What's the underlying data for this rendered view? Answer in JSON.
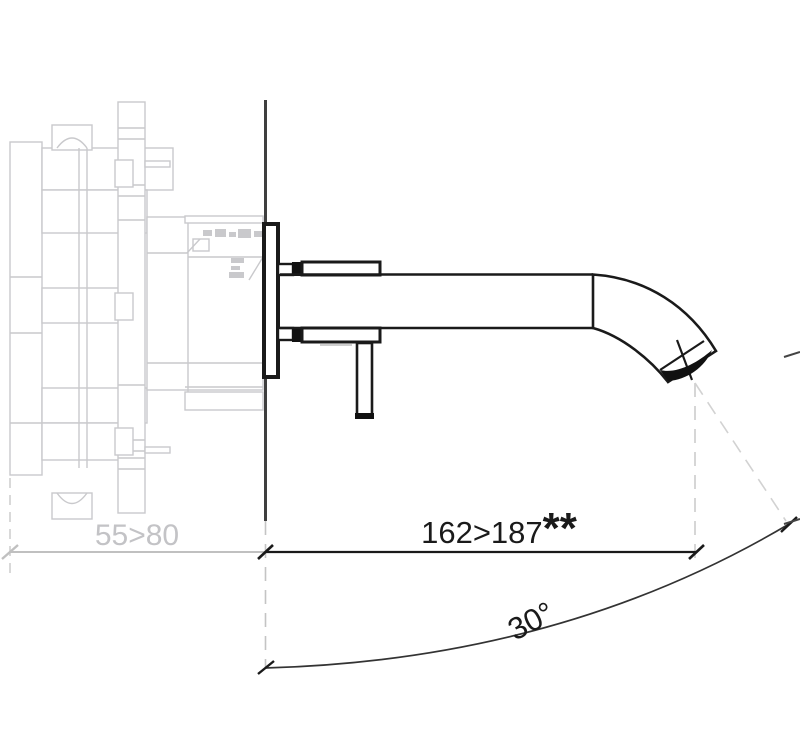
{
  "drawing": {
    "type": "technical-elevation",
    "subject": "wall-mounted single-lever basin mixer with concealed valve body, side view"
  },
  "dimensions": {
    "wall_depth": "55>80",
    "spout_projection": "162>187",
    "spout_projection_note": "**",
    "swivel_angle": "30°"
  },
  "colors": {
    "foreground_line": "#1a1a1a",
    "wall_line": "#3f3f3f",
    "concealed_body_line": "#c9c9cc",
    "dashed_projection_line": "#cccccc",
    "gray_dimension_text": "#c3c3c6",
    "background": "#ffffff"
  }
}
